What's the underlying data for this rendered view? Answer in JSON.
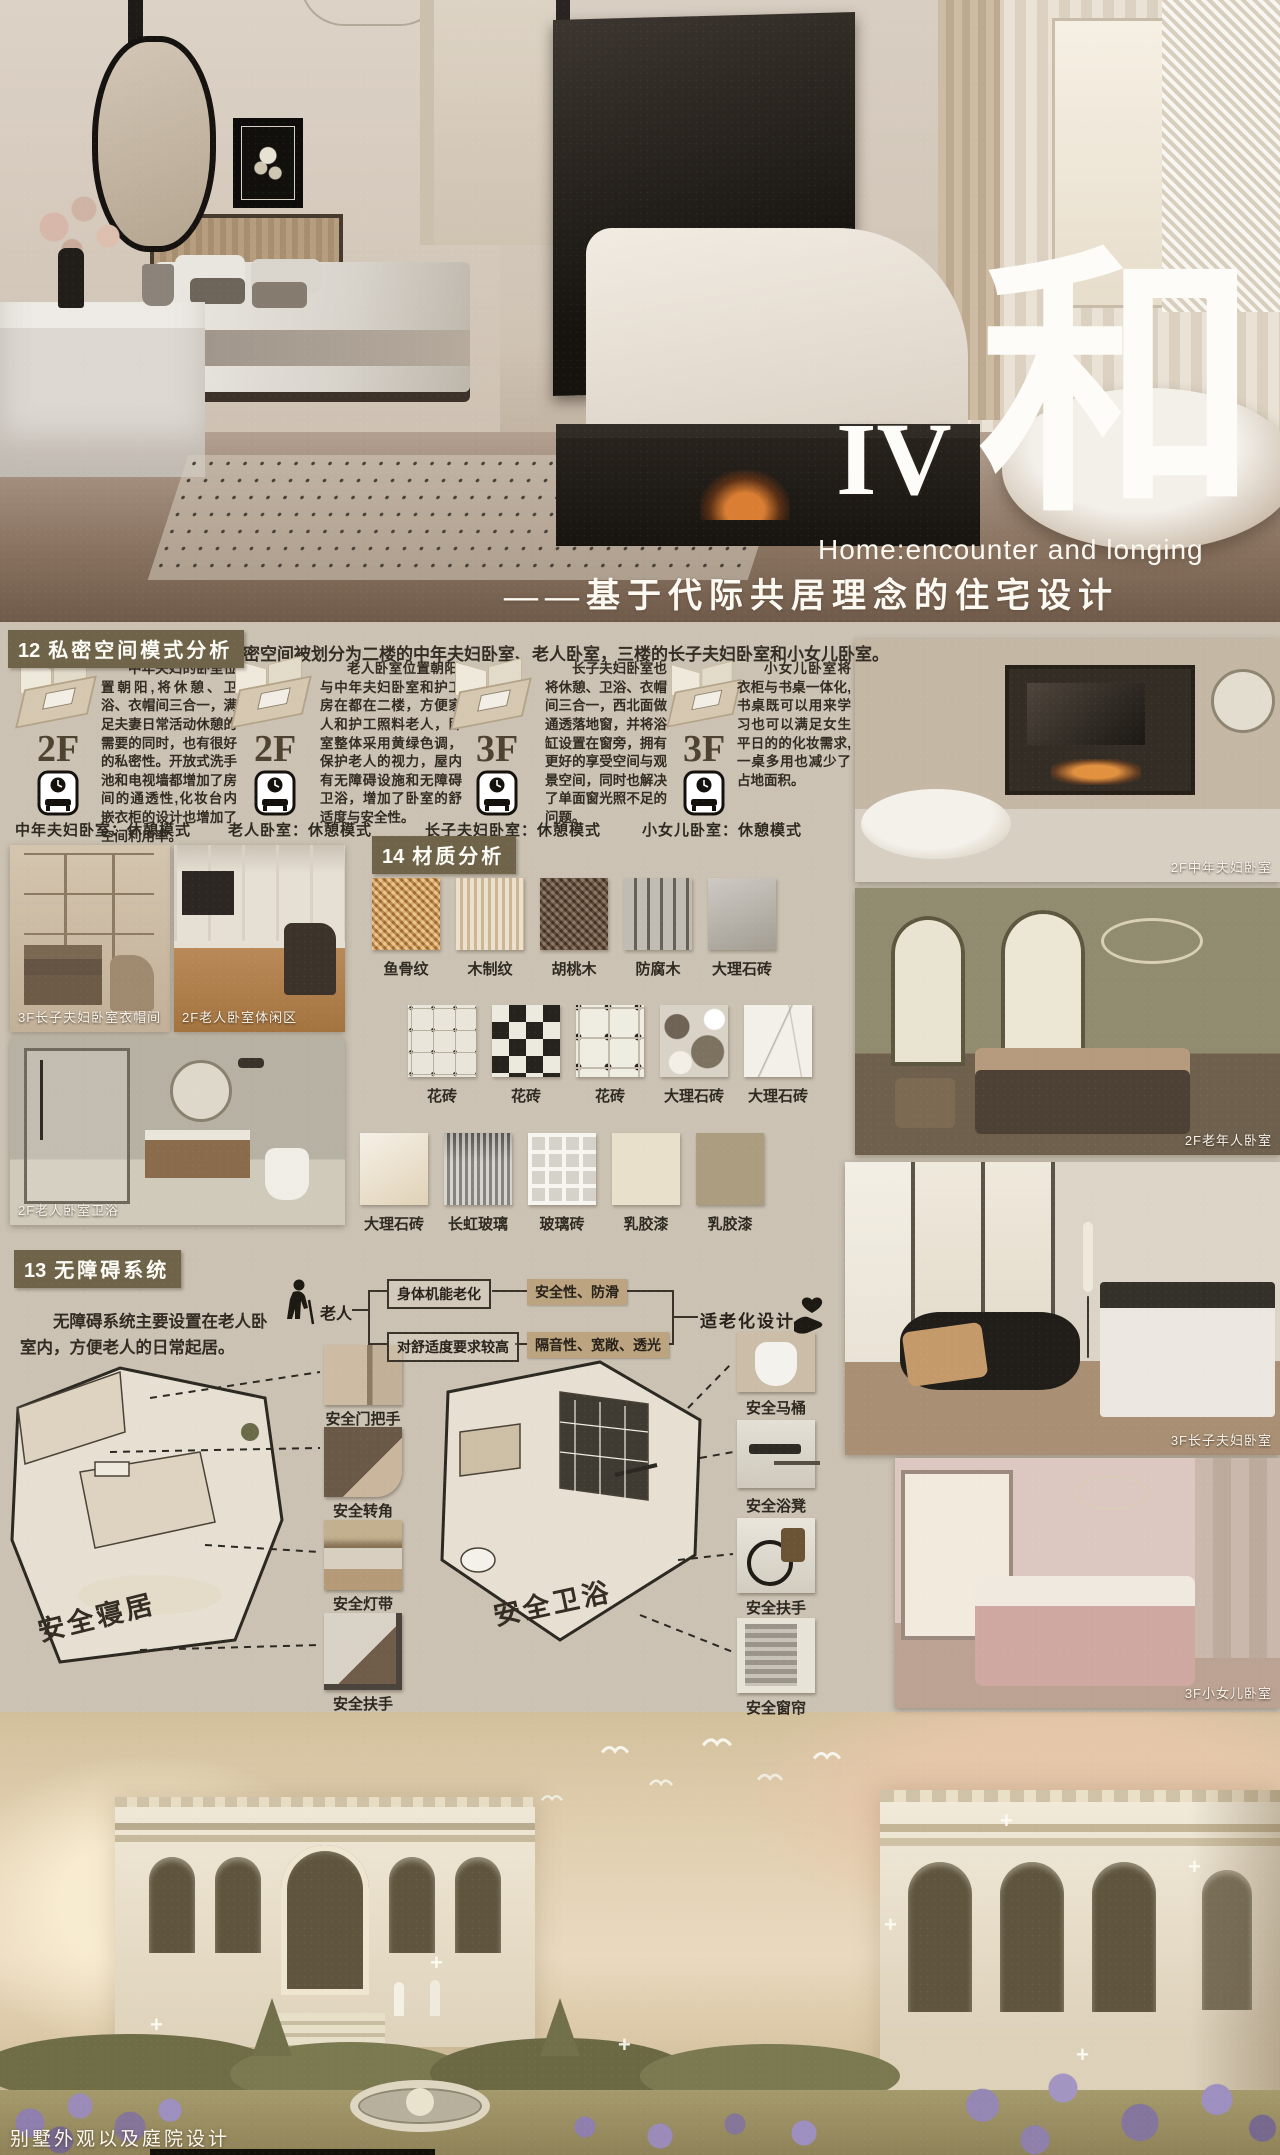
{
  "title": {
    "numeral": "IV",
    "big_char": "和",
    "subtitle_en": "Home:encounter and longing",
    "subtitle_zh": "——基于代际共居理念的住宅设计"
  },
  "section12": {
    "number": "12",
    "heading": "私密空间模式分析",
    "intro": "私密空间被划分为二楼的中年夫妇卧室、老人卧室，三楼的长子夫妇卧室和小女儿卧室。",
    "columns": [
      {
        "floor": "2F",
        "text": "中年夫妇的卧室位置朝阳,将休憩、卫浴、衣帽间三合一，满足夫妻日常活动休憩的需要的同时，也有很好的私密性。开放式洗手池和电视墙都增加了房间的通透性,化妆台内嵌衣柜的设计也增加了空间利用率。",
        "label": "中年夫妇卧室：休憩模式"
      },
      {
        "floor": "2F",
        "text": "老人卧室位置朝阳,与中年夫妇卧室和护工房在都在二楼，方便家人和护工照料老人，卧室整体采用黄绿色调，保护老人的视力，屋内有无障碍设施和无障碍卫浴，增加了卧室的舒适度与安全性。",
        "label": "老人卧室：休憩模式"
      },
      {
        "floor": "3F",
        "text": "长子夫妇卧室也将休憩、卫浴、衣帽间三合一，西北面做通透落地窗，并将浴缸设置在窗旁，拥有更好的享受空间与观景空间，同时也解决了单面窗光照不足的问题。",
        "label": "长子夫妇卧室：休憩模式"
      },
      {
        "floor": "3F",
        "text": "小女儿卧室将衣柜与书桌一体化,书桌既可以用来学习也可以满足女生平日的的化妆需求,一桌多用也减少了占地面积。",
        "label": "小女儿卧室：休憩模式"
      }
    ]
  },
  "section14": {
    "number": "14",
    "heading": "材质分析",
    "rows": [
      [
        "鱼骨纹",
        "木制纹",
        "胡桃木",
        "防腐木",
        "大理石砖"
      ],
      [
        "花砖",
        "花砖",
        "花砖",
        "大理石砖",
        "大理石砖"
      ],
      [
        "大理石砖",
        "长虹玻璃",
        "玻璃砖",
        "乳胶漆",
        "乳胶漆"
      ]
    ]
  },
  "section13": {
    "number": "13",
    "heading": "无障碍系统",
    "intro": "无障碍系统主要设置在老人卧室内，方便老人的日常起居。",
    "flow": {
      "actor": "老人",
      "branch1": "身体机能老化",
      "branch1_result": "安全性、防滑",
      "branch2": "对舒适度要求较高",
      "branch2_result": "隔音性、宽敞、透光",
      "outcome": "适老化设计"
    },
    "diagram1_label": "安全寝居",
    "diagram2_label": "安全卫浴",
    "left_items": [
      "安全门把手",
      "安全转角",
      "安全灯带",
      "安全扶手"
    ],
    "right_items": [
      "安全马桶",
      "安全浴凳",
      "安全扶手",
      "安全窗帘"
    ]
  },
  "photos": {
    "left": [
      "3F长子夫妇卧室衣帽间",
      "2F老人卧室体闲区",
      "2F老人卧室卫浴"
    ],
    "right": [
      "2F中年夫妇卧室",
      "2F老年人卧室",
      "3F长子夫妇卧室",
      "3F小女儿卧室"
    ]
  },
  "footer": {
    "caption": "别墅外观以及庭院设计"
  },
  "colors": {
    "header_bg": "#6f6449",
    "tan_box": "#bba47f",
    "paper": "#cbc2b3"
  }
}
